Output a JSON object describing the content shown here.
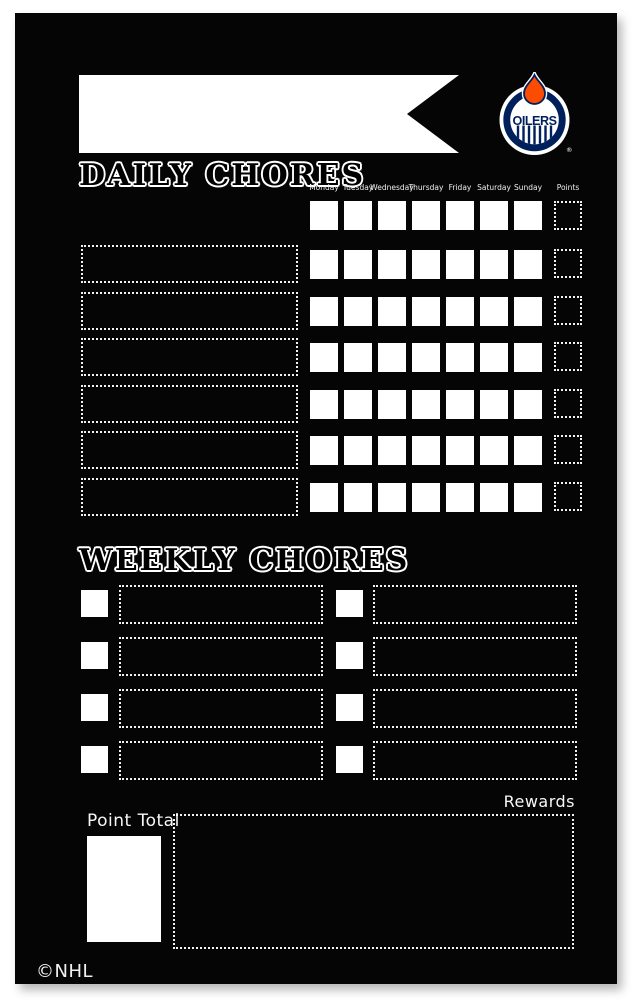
{
  "header": {
    "banner_text": "",
    "logo": {
      "team": "OILERS",
      "registered_mark": "®"
    }
  },
  "daily": {
    "title": "DAILY CHORES",
    "days": [
      "Monday",
      "Tuesday",
      "Wednesday",
      "Thursday",
      "Friday",
      "Saturday",
      "Sunday"
    ],
    "points_label": "Points",
    "chore_row_count": 6
  },
  "weekly": {
    "title": "WEEKLY CHORES",
    "row_count": 4,
    "column_count": 2
  },
  "footer": {
    "point_total_label": "Point Total",
    "rewards_label": "Rewards",
    "nhl_copyright": "©NHL"
  },
  "colors": {
    "board_black": "#050505",
    "white": "#ffffff",
    "oilers_navy": "#00205B",
    "oilers_orange": "#FC4C02"
  }
}
